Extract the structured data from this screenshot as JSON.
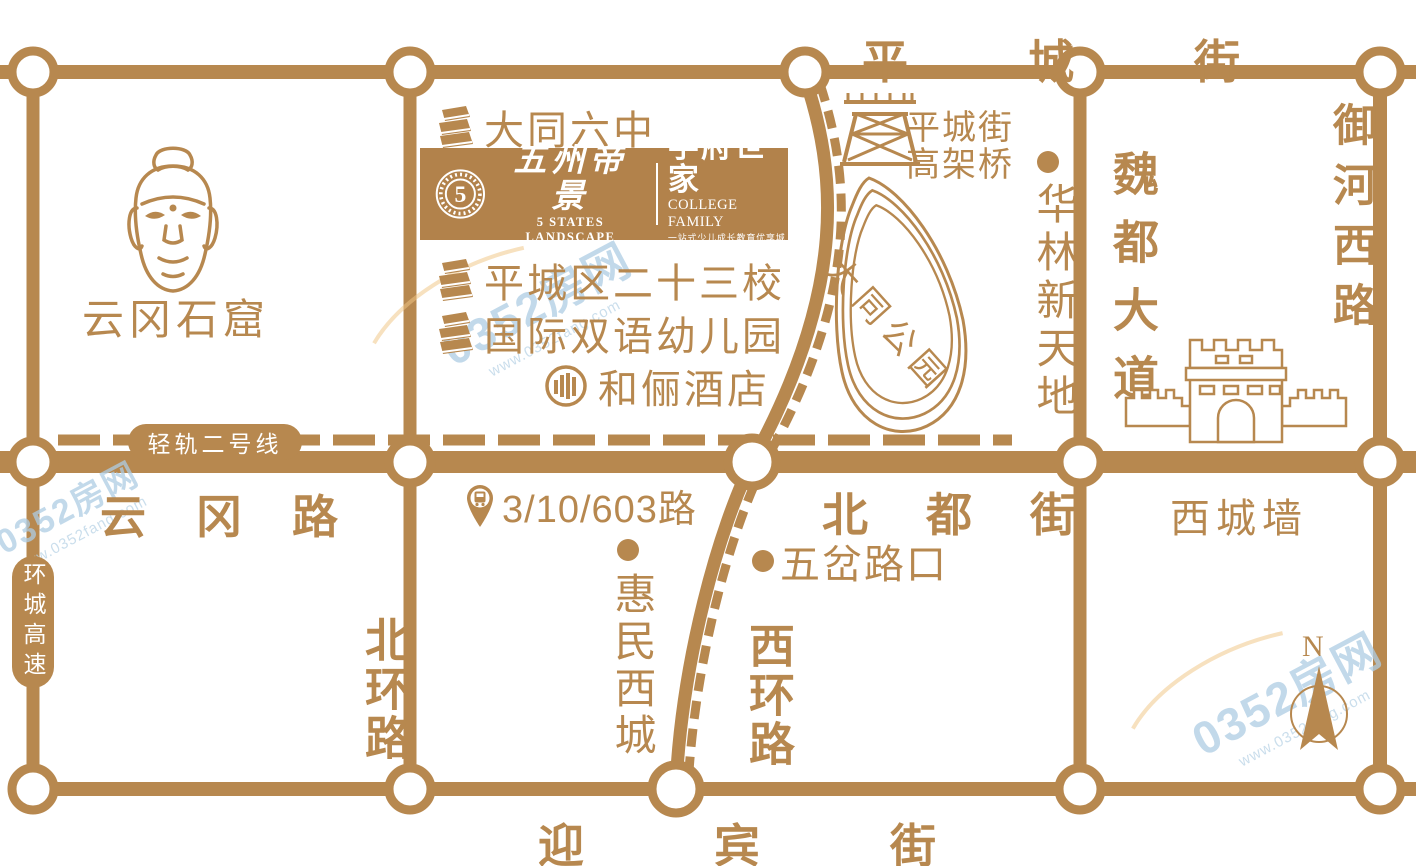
{
  "colors": {
    "road_tan": "#b7884f",
    "banner_bg": "#b2824b",
    "white": "#ffffff",
    "watermark_blue": "#aecde4"
  },
  "watermark": {
    "brand": "0352房网",
    "url": "www.0352fang.com"
  },
  "compass": {
    "north_label": "N"
  },
  "brand": {
    "logo_mark": "5",
    "cn_name": "五州帝景",
    "en_name": "5 STATES LANDSCAPE",
    "sub_cn": "学府世家",
    "sub_en": "COLLEGE FAMILY",
    "slogan": "一站式少儿成长教育优享城邦"
  },
  "roads": {
    "pingcheng_street": "平城街",
    "yungang_road": "云冈路",
    "beidu_street": "北都街",
    "yingbin_street": "迎宾街",
    "weidu_avenue": "魏都大道",
    "yuhe_west_road": "御河西路",
    "beihuan_road": "北环路",
    "xihuan_road": "西环路",
    "huancheng_expressway": "环城高速",
    "light_rail": "轻轨二号线"
  },
  "pois": {
    "yungang_grottoes": "云冈石窟",
    "datong_no6": "大同六中",
    "school23": "平城区二十三校",
    "kindergarten": "国际双语幼儿园",
    "heli_hotel": "和俪酒店",
    "viaduct_line1": "平城街",
    "viaduct_line2": "高架桥",
    "datong_park": "大同公园",
    "hualin": "华林新天地",
    "bus_routes": "3/10/603路",
    "wucha": "五岔路口",
    "huimin": "惠民西城",
    "xicheng_wall": "西城墙"
  }
}
